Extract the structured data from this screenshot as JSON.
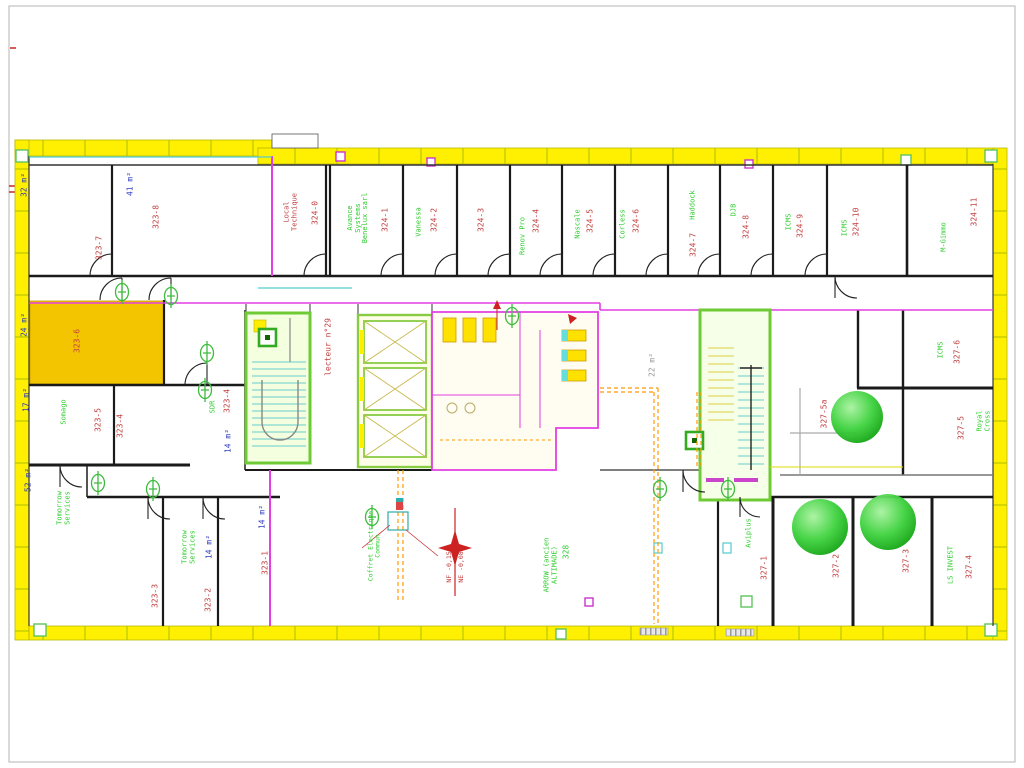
{
  "drawing": {
    "type": "floor-plan",
    "rooms": [
      {
        "number": "323-7",
        "area": "32 m²"
      },
      {
        "number": "323-8",
        "area": "41 m²"
      },
      {
        "number": "324-0",
        "name": "Local\nTechnique"
      },
      {
        "number": "324-1",
        "tenant": "Avance\nSystems\nBenelux sarl"
      },
      {
        "number": "324-2",
        "tenant": "Vanessa"
      },
      {
        "number": "324-3"
      },
      {
        "number": "324-4",
        "tenant": "Renov Pro"
      },
      {
        "number": "324-5",
        "tenant": "Nascale"
      },
      {
        "number": "324-6",
        "tenant": "Corless"
      },
      {
        "number": "324-7",
        "tenant": "Haddock"
      },
      {
        "number": "324-8",
        "tenant": "DJB"
      },
      {
        "number": "324-9",
        "tenant": "ICMS"
      },
      {
        "number": "324-10",
        "tenant": "ICMS"
      },
      {
        "number": "324-11",
        "tenant": "M-Gimmo"
      },
      {
        "number": "323-6",
        "area": "24 m²",
        "highlighted": true
      },
      {
        "number": "323-5",
        "tenant": "Somago",
        "area": "17 m²"
      },
      {
        "number": "323-4"
      },
      {
        "number": "323-4",
        "tenant": "SDR",
        "area": "14 m²"
      },
      {
        "number": "323-3",
        "tenant": "Tomorrow\nServices",
        "area": "52 m²"
      },
      {
        "number": "323-2",
        "tenant": "Tomorrow\nServices",
        "area": "14 m²"
      },
      {
        "number": "323-1",
        "area": "14 m²"
      },
      {
        "number": "328",
        "tenant": "ARROW (ancien\nALTIMADE)"
      },
      {
        "number": "327-6",
        "tenant": "ICMS"
      },
      {
        "number": "327-5",
        "tenant": "Royal Cross"
      },
      {
        "number": "327-5a"
      },
      {
        "number": "327-1",
        "tenant": "Aviplus"
      },
      {
        "number": "327-2"
      },
      {
        "number": "327-3"
      },
      {
        "number": "327-4",
        "tenant": "LS INVEST"
      }
    ],
    "annotations": {
      "corridor_note": "lecteur n°29",
      "core_area": "22 m²",
      "level_nf": "NF -0,15",
      "level_ne": "NE -0,08",
      "electrical_note": "Coffret Electrique\nCommun"
    },
    "colors": {
      "exterior_wall": "#ffef00",
      "highlight_room": "#f2c500",
      "room_number": "#c24040",
      "tenant": "#2fcc2f",
      "area_text": "#2b3bbf",
      "partition": "#e33fe3",
      "duct": "#ff9900",
      "stair": "#6ecb35",
      "tree": "#1fc41f"
    }
  }
}
